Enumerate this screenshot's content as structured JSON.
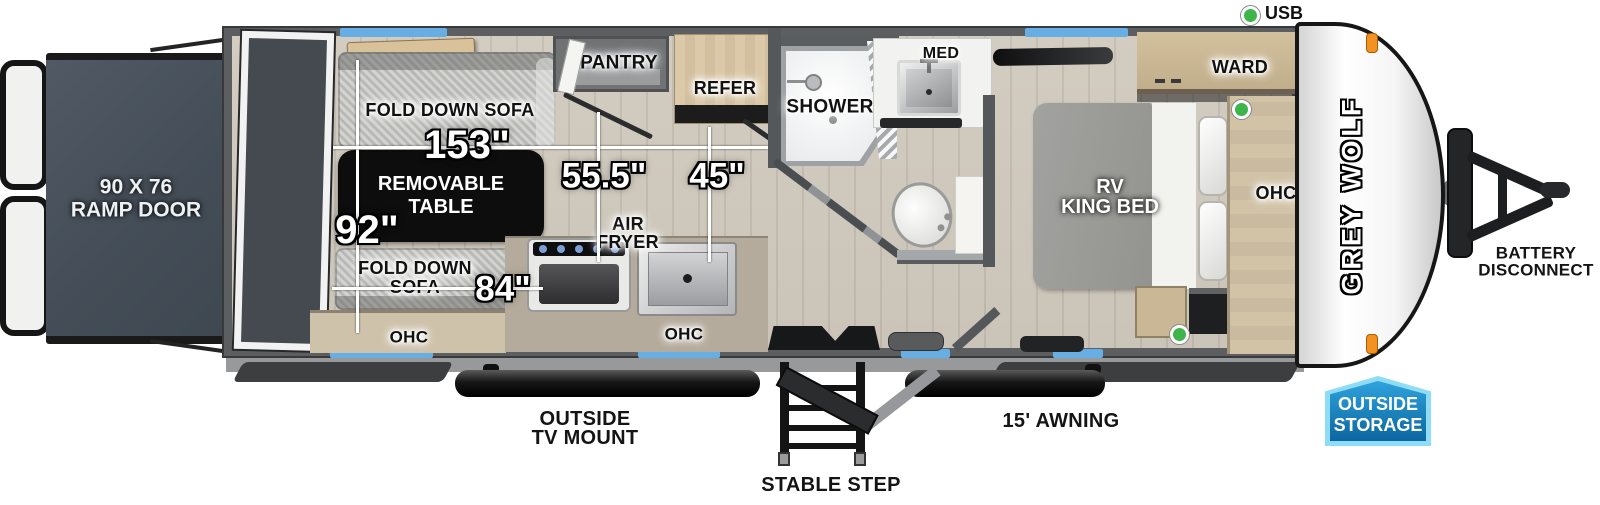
{
  "legend": {
    "usb": "USB"
  },
  "rear": {
    "ramp_line1": "90 X 76",
    "ramp_line2": "RAMP DOOR"
  },
  "garage": {
    "sofa_top_label": "FOLD DOWN SOFA",
    "table_line1": "REMOVABLE",
    "table_line2": "TABLE",
    "sofa_bottom_line1": "FOLD DOWN",
    "sofa_bottom_line2": "SOFA",
    "ohc": "OHC"
  },
  "dimensions": {
    "garage_length": "153\"",
    "interior_width": "92\"",
    "kitchen_to_wall": "55.5\"",
    "refer_to_door": "45\"",
    "sofa_length": "84\""
  },
  "kitchen": {
    "pantry": "PANTRY",
    "refer": "REFER",
    "air_fryer_line1": "AIR",
    "air_fryer_line2": "FRYER",
    "ohc": "OHC"
  },
  "bath": {
    "shower": "SHOWER",
    "med": "MED"
  },
  "bedroom": {
    "bed_line1": "RV",
    "bed_line2": "KING BED",
    "ward": "WARD",
    "ohc": "OHC"
  },
  "front": {
    "brand": "GREY WOLF",
    "battery_line1": "BATTERY",
    "battery_line2": "DISCONNECT"
  },
  "exterior": {
    "tv_mount_line1": "OUTSIDE",
    "tv_mount_line2": "TV MOUNT",
    "stable_step": "STABLE STEP",
    "awning": "15' AWNING",
    "storage_line1": "OUTSIDE",
    "storage_line2": "STORAGE"
  },
  "colors": {
    "window_blue": "#66aee4",
    "usb_green": "#3db54a",
    "storage_badge_fill": "#1a7fc0",
    "storage_badge_border": "#8edcf5",
    "marker_light_orange": "#f49123",
    "ramp_door_gray": "#49525c"
  }
}
